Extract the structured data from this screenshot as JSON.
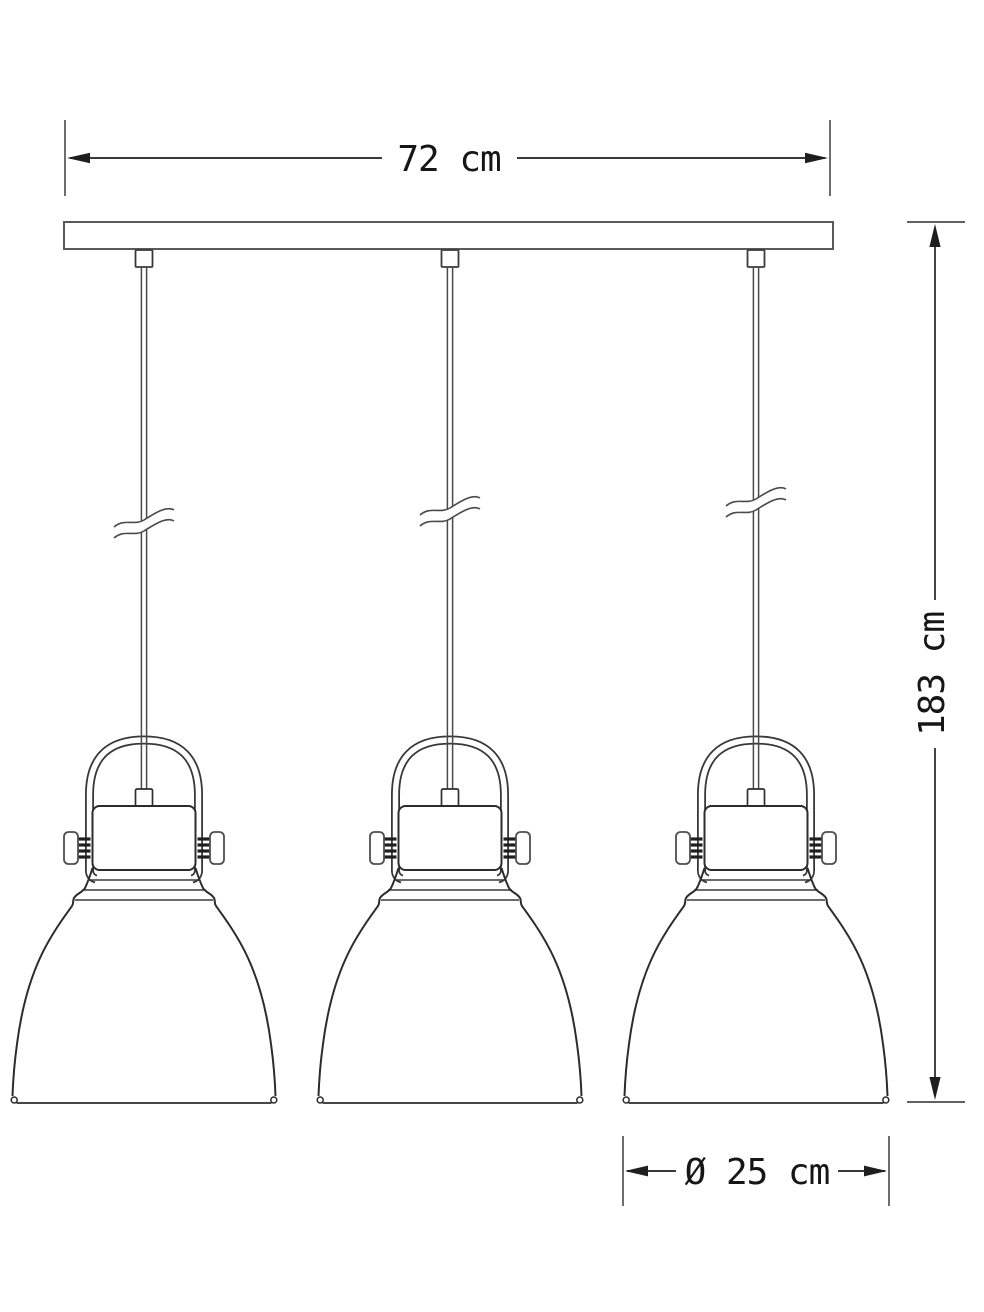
{
  "diagram": {
    "kind": "technical-dimension-drawing",
    "fixture": "three-light pendant lamp",
    "pendant_count": 3
  },
  "dimensions": {
    "width": {
      "label": "72 cm",
      "value_cm": 72,
      "orientation": "horizontal"
    },
    "drop_height": {
      "label": "183 cm",
      "value_cm": 183,
      "orientation": "vertical"
    },
    "shade_diameter": {
      "label": "Ø 25 cm",
      "value_cm": 25,
      "orientation": "horizontal"
    }
  },
  "colors": {
    "background": "#ffffff",
    "outline": "#2c2c2c",
    "dimension_line": "#3a3a3a",
    "text": "#161616"
  }
}
